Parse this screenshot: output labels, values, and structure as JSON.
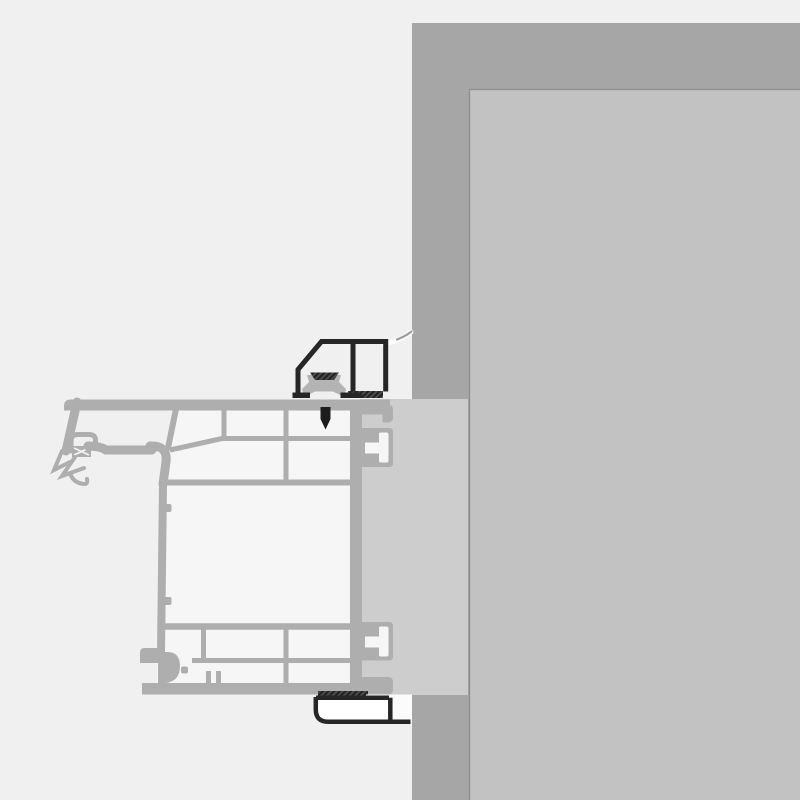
{
  "meta": {
    "type": "technical-section-drawing",
    "description": "Cross-section installation detail of a uPVC window frame profile fixed to a masonry wall with black mounting brackets, fixing screw and compression seals. No text labels are rendered in the drawing.",
    "canvas": {
      "width": 800,
      "height": 800
    }
  },
  "colors": {
    "background": "#f0f0f0",
    "wall_section": "#a6a6a6",
    "wall_inner_face": "#c2c2c2",
    "wall_inner_border": "#8d8d8d",
    "reveal": "#cdcdcd",
    "frame": "#aeaeae",
    "chamber": "#f6f6f6",
    "clip": "#b4b4b4",
    "bracket": "#262626",
    "bracket_fill": "#ffffff",
    "bracket_backing": "#fbfbfb",
    "seal_base": "#4a4a4a",
    "seal_line": "#222222",
    "screw": "#1d1d1d",
    "swoosh_highlight": "#fdfdfd",
    "swoosh_shade": "#9c9c9c"
  },
  "components": [
    {
      "name": "wall-section",
      "role": "masonry wall shown cut in section (dark grey L-band, top and right)"
    },
    {
      "name": "interior-wall-face",
      "role": "wall/reveal surface seen in elevation behind the section"
    },
    {
      "name": "plaster-reveal",
      "role": "light grey filler column between frame and wall"
    },
    {
      "name": "window-frame-profile",
      "role": "multi-chamber uPVC frame profile with internal webs"
    },
    {
      "name": "glazing-gasket-cluster",
      "role": "flexible sealing lips on outdoor side of the frame"
    },
    {
      "name": "anchor-groove-top",
      "role": "T-shaped fixing groove on frame, upper"
    },
    {
      "name": "anchor-groove-bottom",
      "role": "T-shaped fixing groove on frame, lower"
    },
    {
      "name": "top-installation-bracket",
      "role": "black angled mounting bracket on top of frame"
    },
    {
      "name": "adjustment-clip",
      "role": "grey clip block inside top bracket"
    },
    {
      "name": "fixing-screw",
      "role": "black screw driven through bracket into frame"
    },
    {
      "name": "compression-seal-top",
      "role": "dark hatched seal strip under bracket foot"
    },
    {
      "name": "compression-seal-bottom",
      "role": "dark hatched seal strip under frame"
    },
    {
      "name": "bottom-installation-bracket",
      "role": "black L-bracket below frame running to the wall"
    },
    {
      "name": "sealant-membrane",
      "role": "white/grey curved membrane between bracket and wall"
    }
  ]
}
